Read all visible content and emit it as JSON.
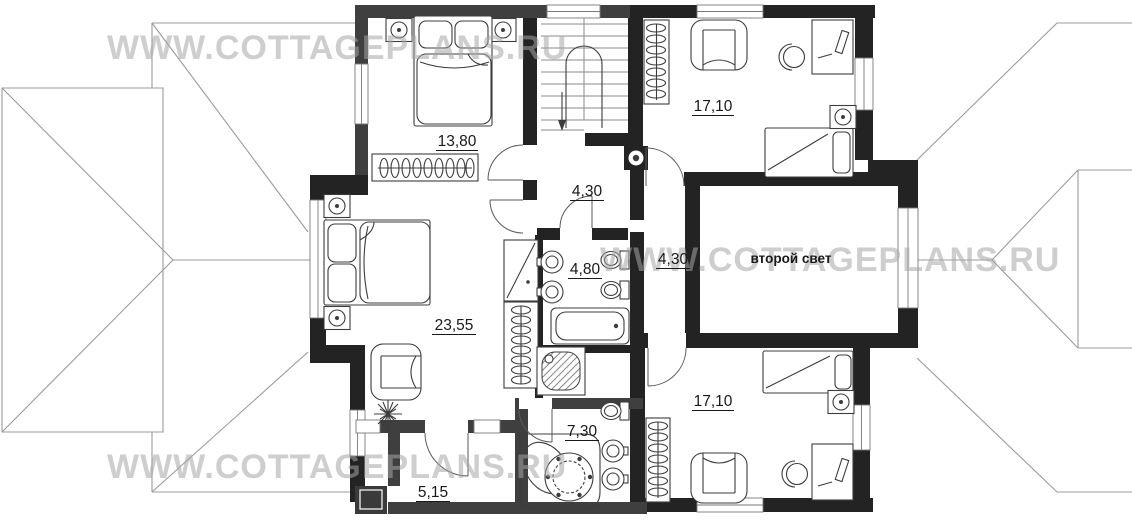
{
  "watermark": {
    "text": "WWW.COTTAGEPLANS.RU"
  },
  "rooms": {
    "bedroom_top_left": {
      "area": "13,80"
    },
    "bedroom_top_right": {
      "area": "17,10"
    },
    "stair_hall": {
      "area": "4,30"
    },
    "bedroom_left": {
      "area": "23,55"
    },
    "bathroom": {
      "area": "4,80"
    },
    "corridor": {
      "area": "4,30"
    },
    "second_light": {
      "label": "второй свет"
    },
    "bedroom_bottom_right": {
      "area": "17,10"
    },
    "bathroom_bottom": {
      "area": "7,30"
    },
    "balcony": {
      "area": "5,15"
    }
  },
  "colors": {
    "wall_dark": "#232323",
    "wall_gray": "#3f3f3f",
    "roof_line": "#9b9b9b",
    "furniture_line": "#3c3c3c",
    "watermark": "#a6a6a6",
    "label": "#191919"
  }
}
